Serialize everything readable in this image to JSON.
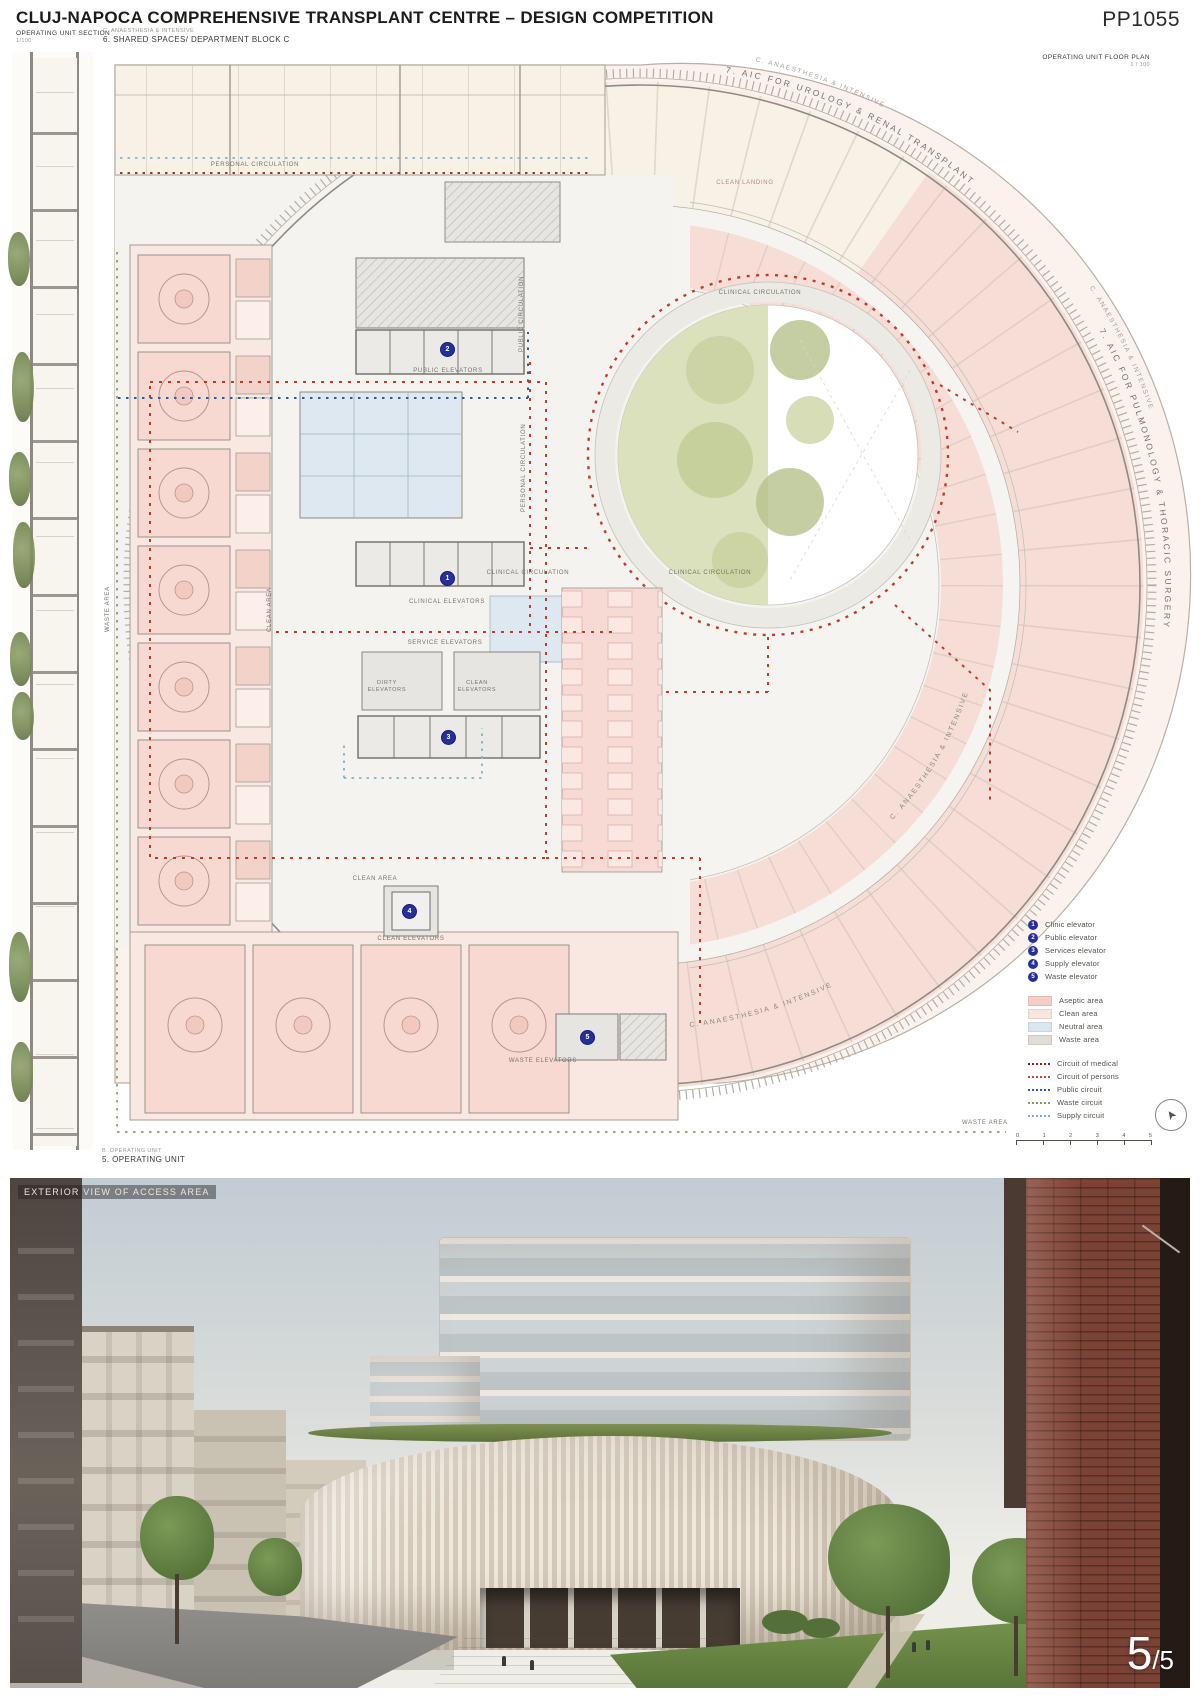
{
  "page": {
    "title": "CLUJ-NAPOCA COMPREHENSIVE TRANSPLANT CENTRE – DESIGN COMPETITION",
    "code": "PP1055"
  },
  "section_panel": {
    "label": "OPERATING UNIT SECTION",
    "scale": "1/100"
  },
  "plan_header": {
    "category": "C. ANAESTHESIA & INTENSIVE",
    "title": "6. SHARED SPACES/ DEPARTMENT BLOCK C"
  },
  "plan_corner": {
    "label": "OPERATING UNIT FLOOR PLAN",
    "scale": "1 / 100"
  },
  "curved": {
    "top_small": "C. ANAESTHESIA & INTENSIVE",
    "top_main": "7. AIC FOR UROLOGY & RENAL TRANSPLANT",
    "right_small": "C. ANAESTHESIA & INTENSIVE",
    "right_main": "7. AIC FOR PULMONOLOGY & THORACIC SURGERY",
    "br_outer": "C. ANAESTHESIA & INTENSIVE",
    "br_inner": "C. ANAESTHESIA & INTENSIVE"
  },
  "plan_labels": {
    "personal_top": "PERSONAL CIRCULATION",
    "clean_landing": "CLEAN LANDING",
    "clinical_top": "CLINICAL CIRCULATION",
    "clinical_left": "CLINICAL CIRCULATION",
    "clinical_right": "CLINICAL CIRCULATION",
    "public_vert": "PUBLIC CIRCULATION",
    "personal_vert": "PERSONAL CIRCULATION",
    "waste_left": "WASTE AREA",
    "clean_left": "CLEAN AREA",
    "clean_bottom": "CLEAN AREA",
    "waste_bottom": "WASTE AREA",
    "public_elev": "PUBLIC ELEVATORS",
    "clinical_elev": "CLINICAL ELEVATORS",
    "service_elev": "SERVICE ELEVATORS",
    "dirty_elev": "DIRTY ELEVATORS",
    "clean_elev_core": "CLEAN ELEVATORS",
    "clean_elev": "CLEAN ELEVATORS",
    "waste_elev": "WASTE ELEVATORS"
  },
  "markers": {
    "m1": "1",
    "m2": "2",
    "m3": "3",
    "m4": "4",
    "m5": "5"
  },
  "legend": {
    "elevators": [
      {
        "num": "1",
        "label": "Clinic elevator"
      },
      {
        "num": "2",
        "label": "Public elevator"
      },
      {
        "num": "3",
        "label": "Services elevator"
      },
      {
        "num": "4",
        "label": "Supply elevator"
      },
      {
        "num": "5",
        "label": "Waste elevator"
      }
    ],
    "areas": [
      {
        "label": "Aseptic area",
        "color": "#f2cec5"
      },
      {
        "label": "Clean area",
        "color": "#f8e6dc"
      },
      {
        "label": "Neutral area",
        "color": "#d9e5ef"
      },
      {
        "label": "Waste area",
        "color": "#e1dcd4"
      }
    ],
    "circuits": [
      {
        "label": "Circuit of medical",
        "color": "#8e1f14"
      },
      {
        "label": "Circuit of persons",
        "color": "#c4473a"
      },
      {
        "label": "Public circuit",
        "color": "#2b5ba0"
      },
      {
        "label": "Waste circuit",
        "color": "#8a9a70"
      },
      {
        "label": "Supply circuit",
        "color": "#7fb2c5"
      }
    ],
    "scale_ticks": [
      "0",
      "1",
      "2",
      "3",
      "4",
      "5"
    ]
  },
  "footer": {
    "category": "B. OPERATING UNIT",
    "title": "5. OPERATING UNIT"
  },
  "photo": {
    "caption": "EXTERIOR VIEW OF ACCESS AREA",
    "page_big": "5",
    "page_small": "/5"
  }
}
